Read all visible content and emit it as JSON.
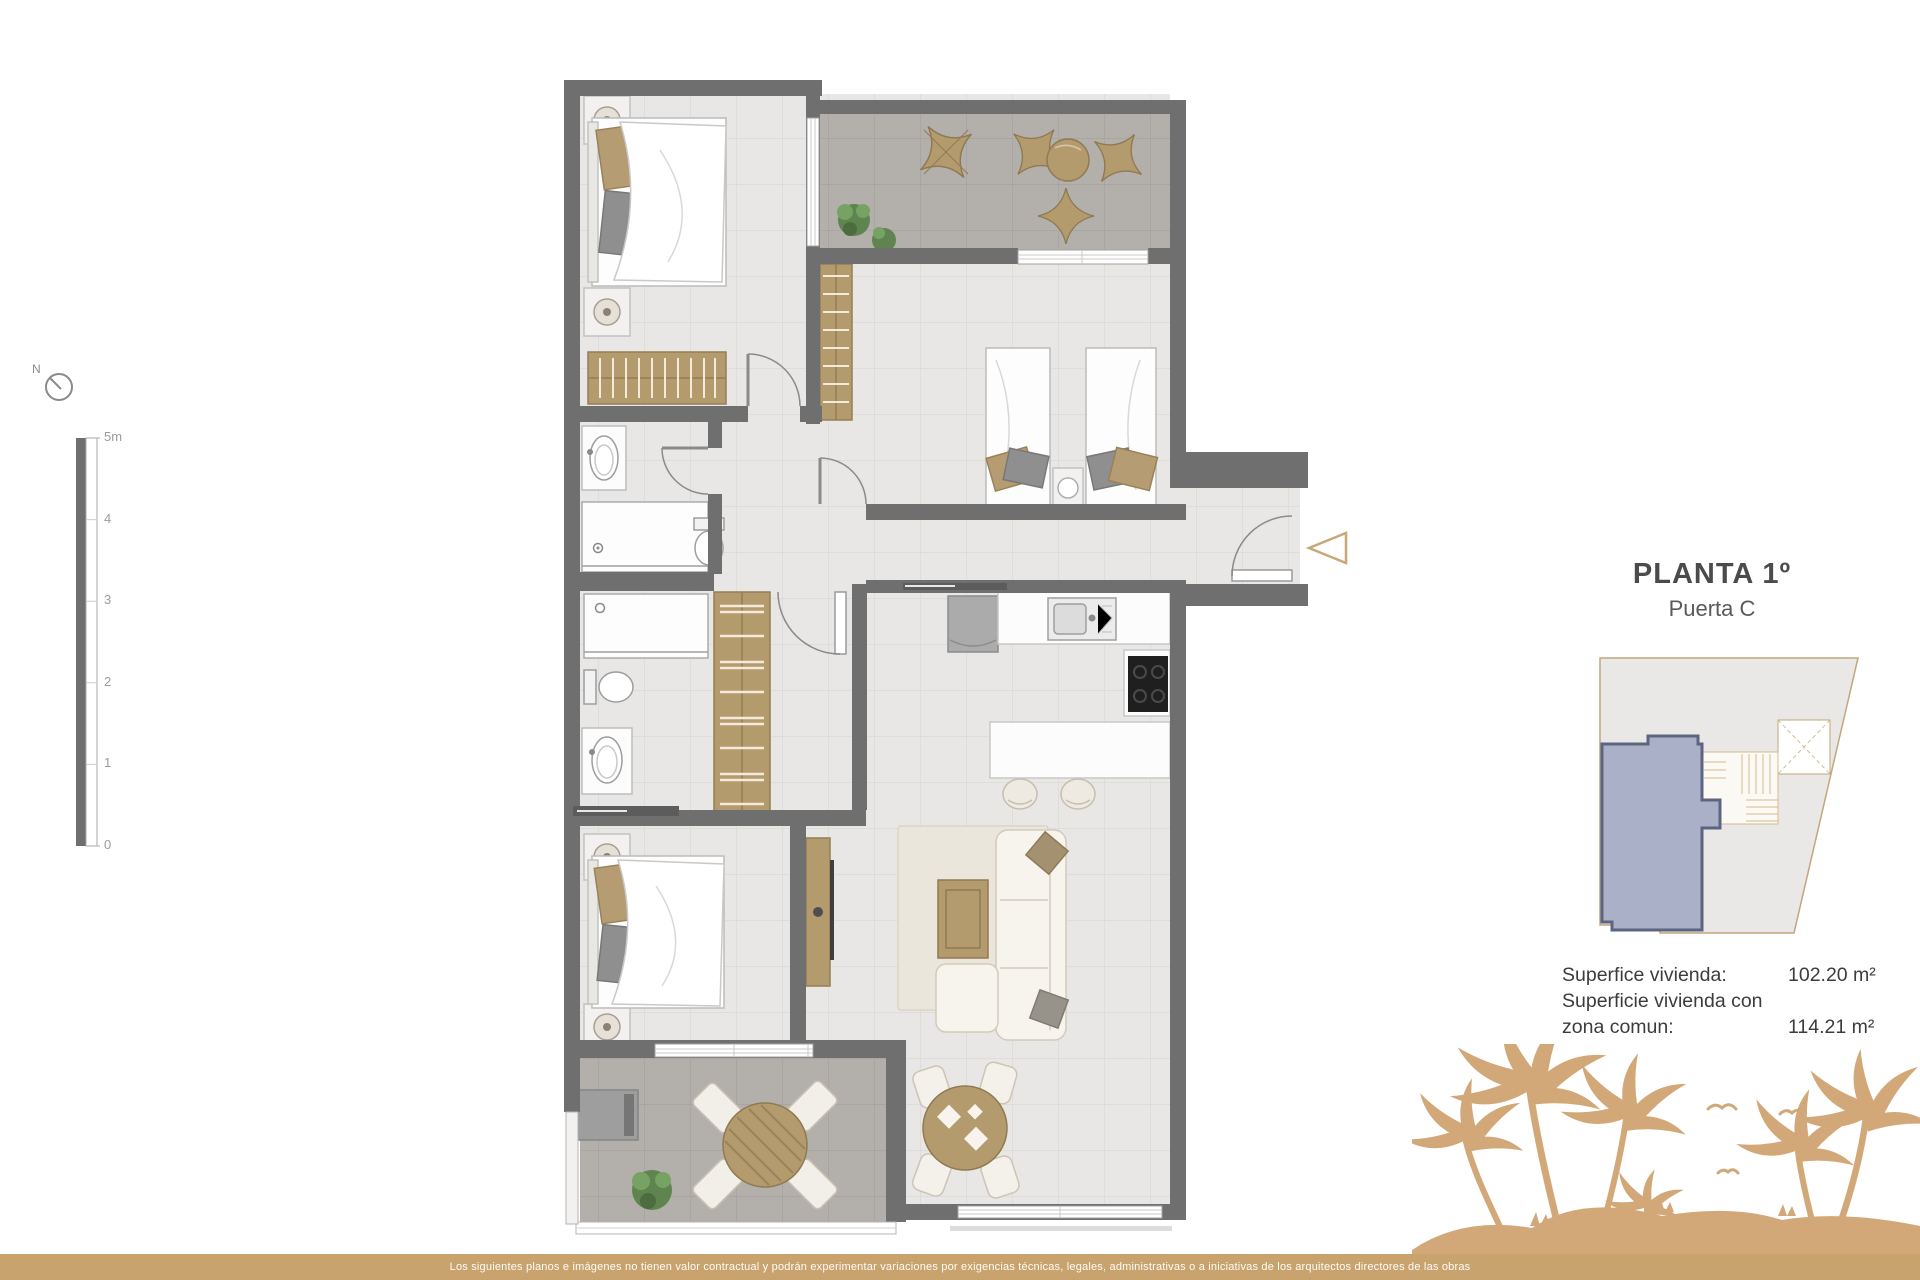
{
  "header": {
    "title": "PLANTA 1º",
    "subtitle": "Puerta C"
  },
  "compass": {
    "north_label": "N"
  },
  "scale_bar": {
    "labels": [
      "5m",
      "4",
      "3",
      "2",
      "1",
      "0"
    ]
  },
  "area_info": {
    "label1": "Superfice vivienda:",
    "value1": "102.20 m²",
    "label2_line1": "Superficie vivienda con",
    "label2_line2": "zona comun:",
    "value2": "114.21 m²"
  },
  "footer": {
    "disclaimer": "Los siguientes planos e imágenes no tienen valor contractual y podrán experimentar variaciones por exigencias técnicas, legales, administrativas o a iniciativas de los arquitectos directores de las obras"
  },
  "colors": {
    "accent_gold": "#c8a36e",
    "palm_gold": "#d2a878",
    "wall_grey": "#6f6f6f",
    "interior_floor": "#e8e7e5",
    "terrace_floor": "#b3b0ab",
    "wood_furniture": "#b49b6e",
    "unit_highlight_fill": "#a9b0c7",
    "unit_highlight_border": "#5d6480"
  },
  "icons": {
    "compass": "north-compass-icon",
    "entrance_arrow": "entrance-arrow-icon"
  }
}
